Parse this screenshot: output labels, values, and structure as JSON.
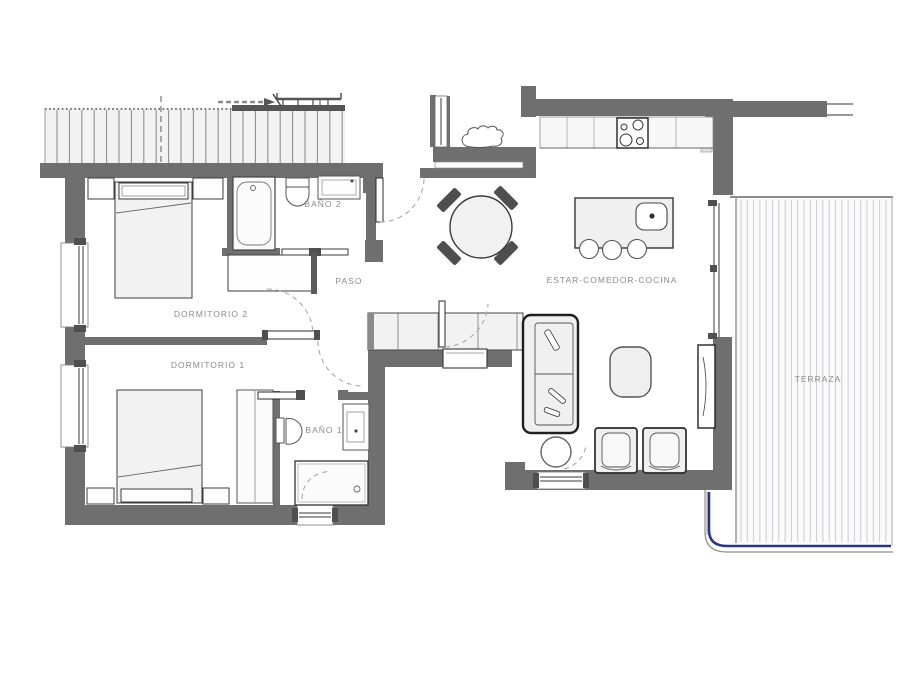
{
  "plan": {
    "background": "#ffffff",
    "labels": {
      "dormitorio2": "DORMITORIO 2",
      "dormitorio1": "DORMITORIO 1",
      "bano2": "BAÑO 2",
      "bano1": "BAÑO 1",
      "paso": "PASO",
      "estar_comedor_cocina": "ESTAR-COMEDOR-COCINA",
      "terraza": "TERRAZA"
    },
    "colors": {
      "wall": "#6f6f6f",
      "wall_dark": "#4f4f4f",
      "fixture_fill": "#f2f2f2",
      "fixture_stroke": "#3c3c3c",
      "detail_stroke": "#8c8c8c",
      "label_text": "#8a8a8a",
      "hatch_top": "#8f8f8f",
      "hatch_terrace": "#c9c9cd",
      "terrace_rail": "#2a3580"
    },
    "fixtures": [
      "double-bed",
      "nightstand",
      "wardrobe",
      "closet-bank",
      "bathtub",
      "shower",
      "toilet",
      "washbasin",
      "kitchen-counter",
      "cooktop",
      "kitchen-island",
      "island-sink",
      "bar-stool",
      "dining-table",
      "dining-chair",
      "sofa",
      "coffee-table",
      "armchair",
      "side-table",
      "tv-unit",
      "radiator",
      "terrace-deck"
    ]
  }
}
